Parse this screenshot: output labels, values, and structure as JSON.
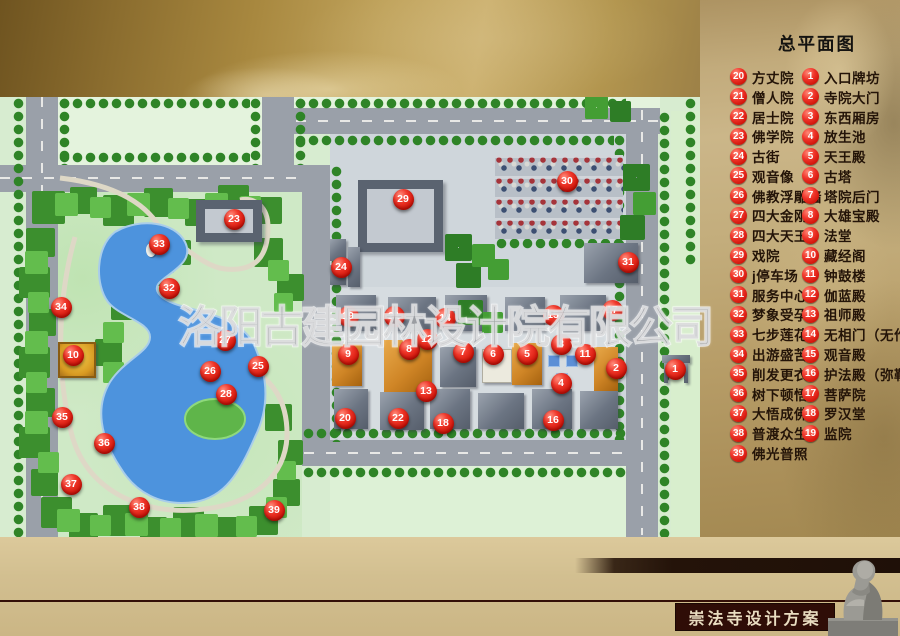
{
  "header": {
    "title": "总平面图"
  },
  "watermark": "洛阳古建园林设计院有限公司",
  "footer": {
    "label": "崇法寺设计方案"
  },
  "colors": {
    "marker_red": "#e0201a",
    "lake_blue": "#4d93dd",
    "road_gray": "#9aa0a9",
    "ground_green": "#d7ecd0",
    "panel_gold": "#c2ab7c",
    "banner_dark": "#2f0d07"
  },
  "legend": {
    "left": [
      {
        "num": "20",
        "label": "方丈院"
      },
      {
        "num": "21",
        "label": "僧人院"
      },
      {
        "num": "22",
        "label": "居士院"
      },
      {
        "num": "23",
        "label": "佛学院"
      },
      {
        "num": "24",
        "label": "古街"
      },
      {
        "num": "25",
        "label": "观音像"
      },
      {
        "num": "26",
        "label": "佛教浮雕墙"
      },
      {
        "num": "27",
        "label": "四大金刚"
      },
      {
        "num": "28",
        "label": "四大天王"
      },
      {
        "num": "29",
        "label": "戏院"
      },
      {
        "num": "30",
        "label": "j停车场"
      },
      {
        "num": "31",
        "label": "服务中心"
      },
      {
        "num": "32",
        "label": "梦象受孕"
      },
      {
        "num": "33",
        "label": "七步莲花"
      },
      {
        "num": "34",
        "label": "出游盛苦"
      },
      {
        "num": "35",
        "label": "削发更衣"
      },
      {
        "num": "36",
        "label": "树下顿悟"
      },
      {
        "num": "37",
        "label": "大悟成佛"
      },
      {
        "num": "38",
        "label": "普渡众生"
      },
      {
        "num": "39",
        "label": "佛光普照"
      }
    ],
    "right": [
      {
        "num": "1",
        "label": "入口牌坊"
      },
      {
        "num": "2",
        "label": "寺院大门"
      },
      {
        "num": "3",
        "label": "东西厢房"
      },
      {
        "num": "4",
        "label": "放生池"
      },
      {
        "num": "5",
        "label": "天王殿"
      },
      {
        "num": "6",
        "label": "古塔"
      },
      {
        "num": "7",
        "label": "塔院后门"
      },
      {
        "num": "8",
        "label": "大雄宝殿"
      },
      {
        "num": "9",
        "label": "法堂"
      },
      {
        "num": "10",
        "label": "藏经阁"
      },
      {
        "num": "11",
        "label": "钟鼓楼"
      },
      {
        "num": "12",
        "label": "伽蓝殿"
      },
      {
        "num": "13",
        "label": "祖师殿"
      },
      {
        "num": "14",
        "label": "无相门（无作门）"
      },
      {
        "num": "15",
        "label": "观音殿"
      },
      {
        "num": "16",
        "label": "护法殿（弥勒殿）"
      },
      {
        "num": "17",
        "label": "菩萨院"
      },
      {
        "num": "18",
        "label": "罗汉堂"
      },
      {
        "num": "19",
        "label": "监院"
      }
    ]
  },
  "map_markers": [
    {
      "num": "1",
      "x": 675,
      "y": 369
    },
    {
      "num": "2",
      "x": 616,
      "y": 368
    },
    {
      "num": "3",
      "x": 561,
      "y": 344
    },
    {
      "num": "4",
      "x": 561,
      "y": 383
    },
    {
      "num": "5",
      "x": 527,
      "y": 354
    },
    {
      "num": "6",
      "x": 493,
      "y": 354
    },
    {
      "num": "7",
      "x": 463,
      "y": 352
    },
    {
      "num": "8",
      "x": 409,
      "y": 349
    },
    {
      "num": "9",
      "x": 348,
      "y": 354
    },
    {
      "num": "10",
      "x": 73,
      "y": 355
    },
    {
      "num": "11",
      "x": 585,
      "y": 354
    },
    {
      "num": "12",
      "x": 427,
      "y": 339
    },
    {
      "num": "13",
      "x": 426,
      "y": 391
    },
    {
      "num": "14",
      "x": 445,
      "y": 318
    },
    {
      "num": "15",
      "x": 553,
      "y": 315
    },
    {
      "num": "16",
      "x": 553,
      "y": 420
    },
    {
      "num": "17",
      "x": 612,
      "y": 310
    },
    {
      "num": "18",
      "x": 443,
      "y": 423
    },
    {
      "num": "19",
      "x": 348,
      "y": 316
    },
    {
      "num": "20",
      "x": 345,
      "y": 418
    },
    {
      "num": "21",
      "x": 394,
      "y": 316
    },
    {
      "num": "22",
      "x": 398,
      "y": 418
    },
    {
      "num": "23",
      "x": 234,
      "y": 219
    },
    {
      "num": "24",
      "x": 341,
      "y": 267
    },
    {
      "num": "25",
      "x": 258,
      "y": 366
    },
    {
      "num": "26",
      "x": 210,
      "y": 371
    },
    {
      "num": "27",
      "x": 225,
      "y": 340
    },
    {
      "num": "28",
      "x": 226,
      "y": 394
    },
    {
      "num": "29",
      "x": 403,
      "y": 199
    },
    {
      "num": "30",
      "x": 567,
      "y": 181
    },
    {
      "num": "31",
      "x": 628,
      "y": 262
    },
    {
      "num": "32",
      "x": 169,
      "y": 288
    },
    {
      "num": "33",
      "x": 159,
      "y": 244
    },
    {
      "num": "34",
      "x": 61,
      "y": 307
    },
    {
      "num": "35",
      "x": 62,
      "y": 417
    },
    {
      "num": "36",
      "x": 104,
      "y": 443
    },
    {
      "num": "37",
      "x": 71,
      "y": 484
    },
    {
      "num": "38",
      "x": 139,
      "y": 507
    },
    {
      "num": "39",
      "x": 274,
      "y": 510
    }
  ]
}
